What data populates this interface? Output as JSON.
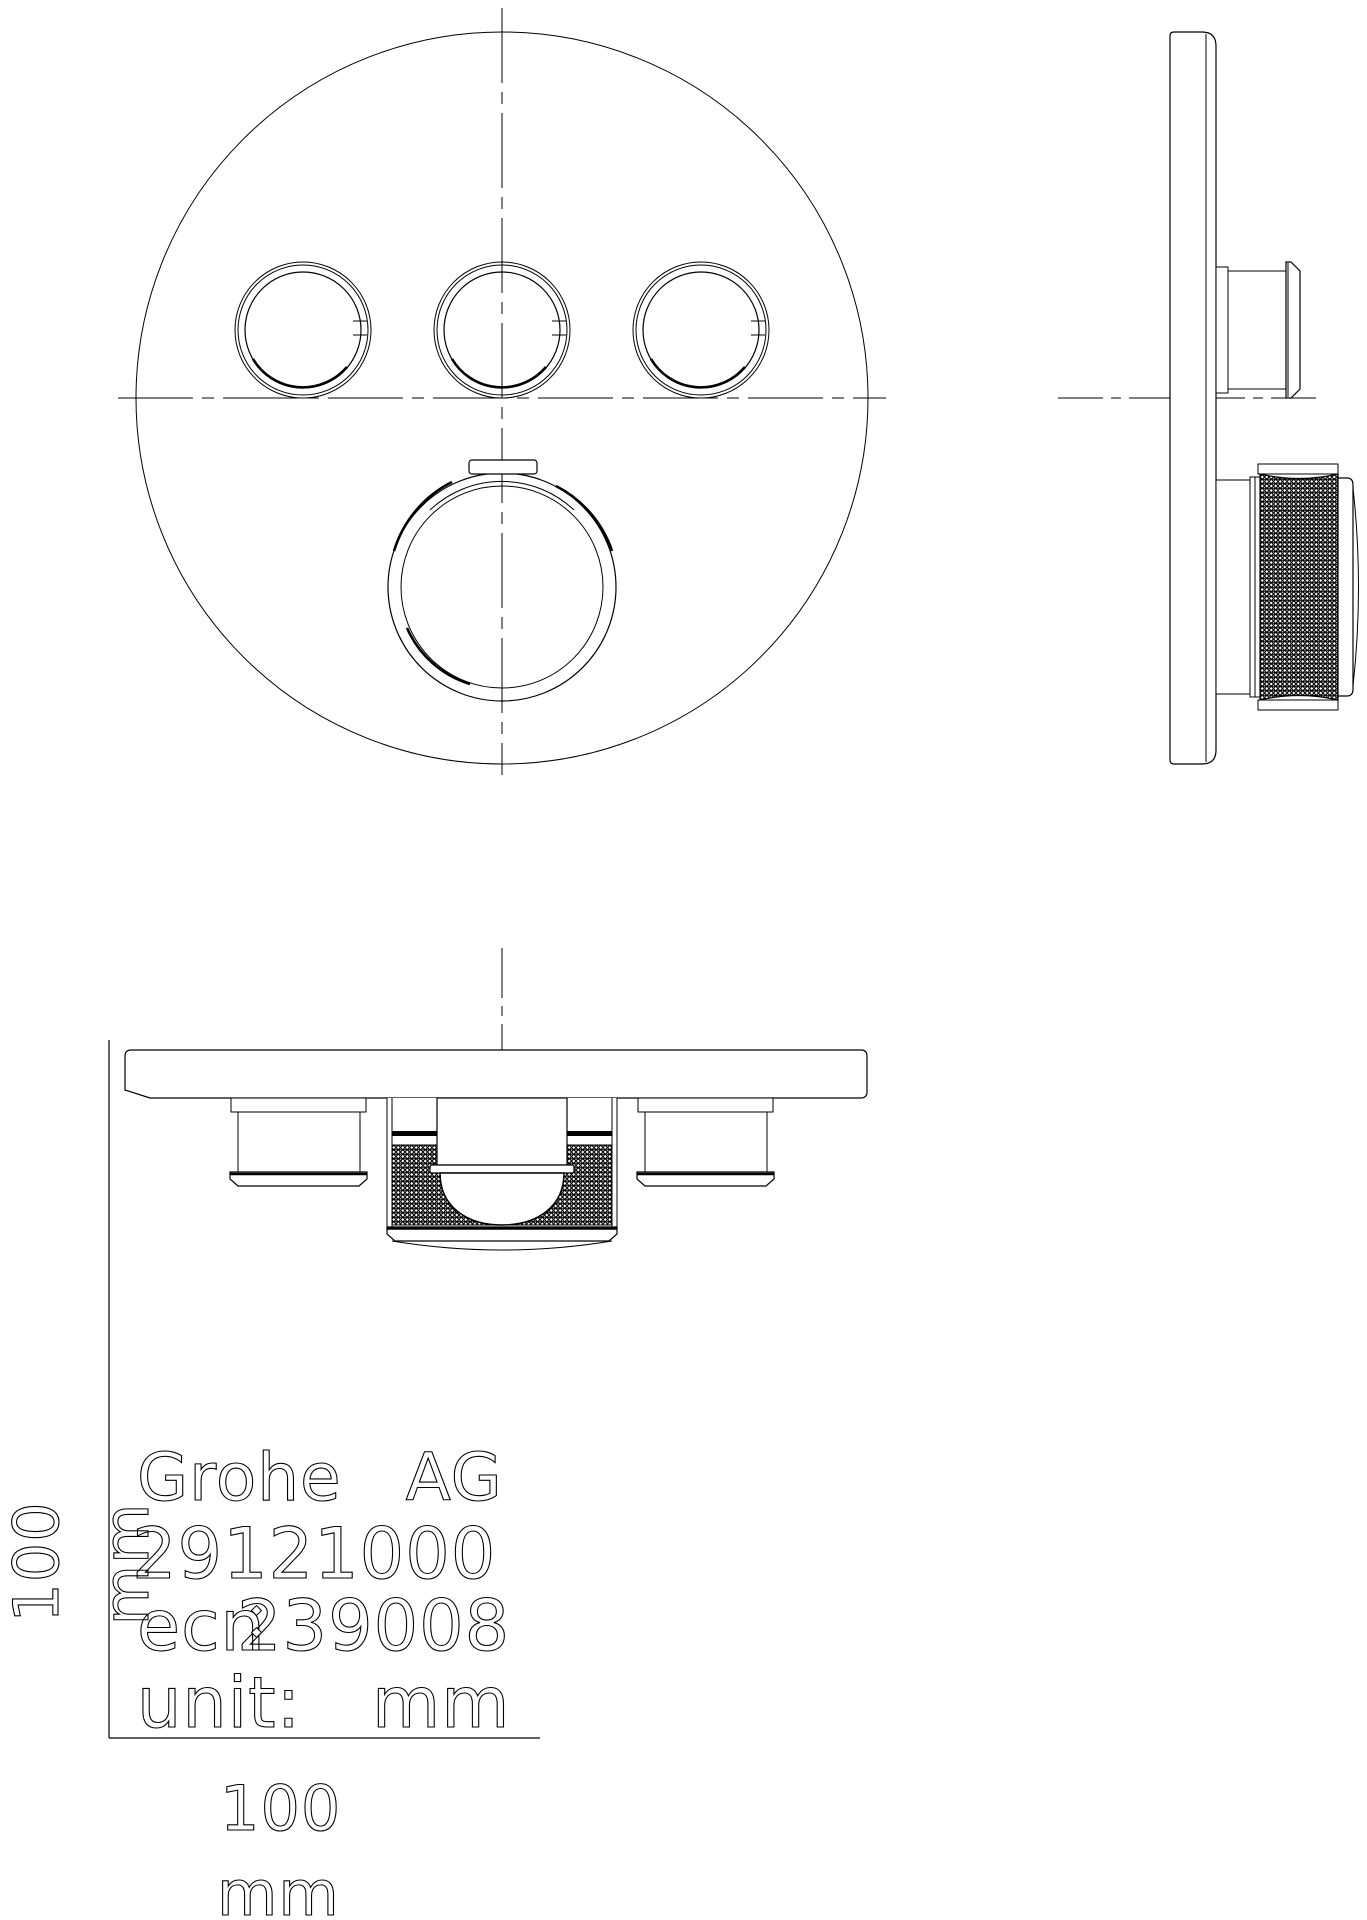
{
  "drawing": {
    "colors": {
      "background": "#ffffff",
      "line": "#000000"
    },
    "title_block": {
      "manufacturer": "Grohe AG",
      "product_number": "29121000",
      "ecn_label": "ecn",
      "ecn_number": "239008",
      "unit_label": "unit:",
      "unit_value": "mm"
    },
    "dimensions": {
      "height_value": "100",
      "height_unit": "mm",
      "width_value": "100",
      "width_unit": "mm"
    }
  }
}
